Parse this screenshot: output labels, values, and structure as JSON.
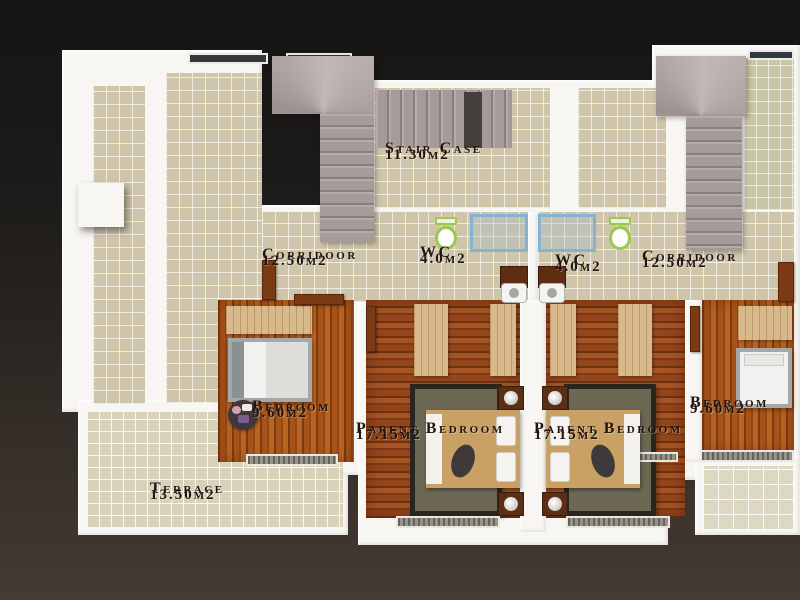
{
  "rooms": [
    {
      "id": "staircase",
      "name": "Stair Case",
      "area": "11.30m2"
    },
    {
      "id": "corridor_left",
      "name": "Corridoor",
      "area": "12.50m2"
    },
    {
      "id": "wc_left",
      "name": "WC",
      "area": "4.0m2"
    },
    {
      "id": "wc_right",
      "name": "WC",
      "area": "4.0m2"
    },
    {
      "id": "corridor_right",
      "name": "Corridoor",
      "area": "12.50m2"
    },
    {
      "id": "bedroom_left",
      "name": "Bedroom",
      "area": "9.60m2"
    },
    {
      "id": "parent_bedroom_left",
      "name": "Parent Bedroom",
      "area": "17.15m2"
    },
    {
      "id": "parent_bedroom_right",
      "name": "Parent Bedroom",
      "area": "17.15m2"
    },
    {
      "id": "bedroom_right",
      "name": "Bedroom",
      "area": "9.60m2"
    },
    {
      "id": "terrace",
      "name": "Terrace",
      "area": "13.50m2"
    }
  ],
  "fixtures": [
    "staircase-left",
    "staircase-right",
    "toilet-left",
    "toilet-right",
    "shower-left",
    "shower-right",
    "vanity-sink-left",
    "vanity-sink-right",
    "single-bed-left",
    "single-bed-right",
    "double-bed-left",
    "double-bed-right",
    "rug-left",
    "rug-right",
    "wardrobes",
    "nightstands",
    "chimney-box"
  ],
  "colors": {
    "background_top": "#161514",
    "background_bottom": "#443b32",
    "wall": "#f7f6f2",
    "tile_beige": "#cfc5aa",
    "tile_terrace": "#d9d2bb",
    "wood_light": "#a0501c",
    "wood_dark": "#8f4418",
    "stairs": "#a89c9a",
    "rug": "#6d6854",
    "toilet_seat_green": "#9cc84b",
    "shower_blue": "#86b3d2",
    "door_wood": "#7a3a14",
    "label_text": "#221510"
  }
}
